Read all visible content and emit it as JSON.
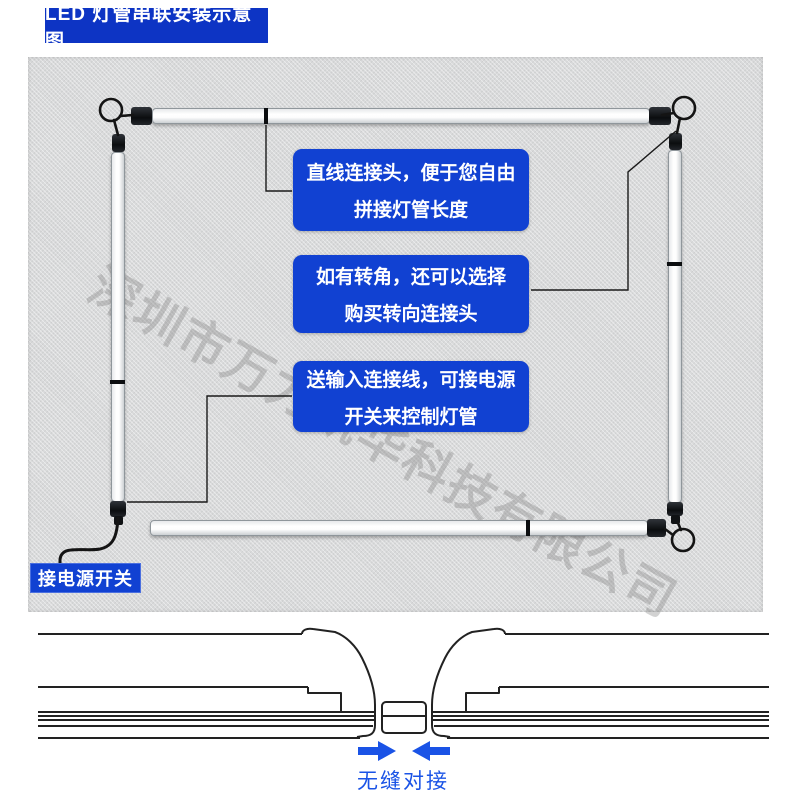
{
  "page": {
    "title_badge": "LED 灯管串联安装示意图"
  },
  "diagram": {
    "watermark": "深圳市万力凯华科技有限公司",
    "power_switch_label": "接电源开关",
    "callouts": [
      {
        "line1": "直线连接头，便于您自由",
        "line2": "拼接灯管长度"
      },
      {
        "line1": "如有转角，还可以选择",
        "line2": "购买转向连接头"
      },
      {
        "line1": "送输入连接线，可接电源",
        "line2": "开关来控制灯管"
      }
    ]
  },
  "bottom_diagram": {
    "caption": "无缝对接"
  },
  "icons": {
    "arrow_right": "right-arrow",
    "arrow_left": "left-arrow"
  },
  "colors": {
    "badge_blue": "#0d34c4",
    "callout_blue": "#1141d2",
    "accent_blue": "#1a53e6",
    "panel_gray": "#d9dadb"
  }
}
